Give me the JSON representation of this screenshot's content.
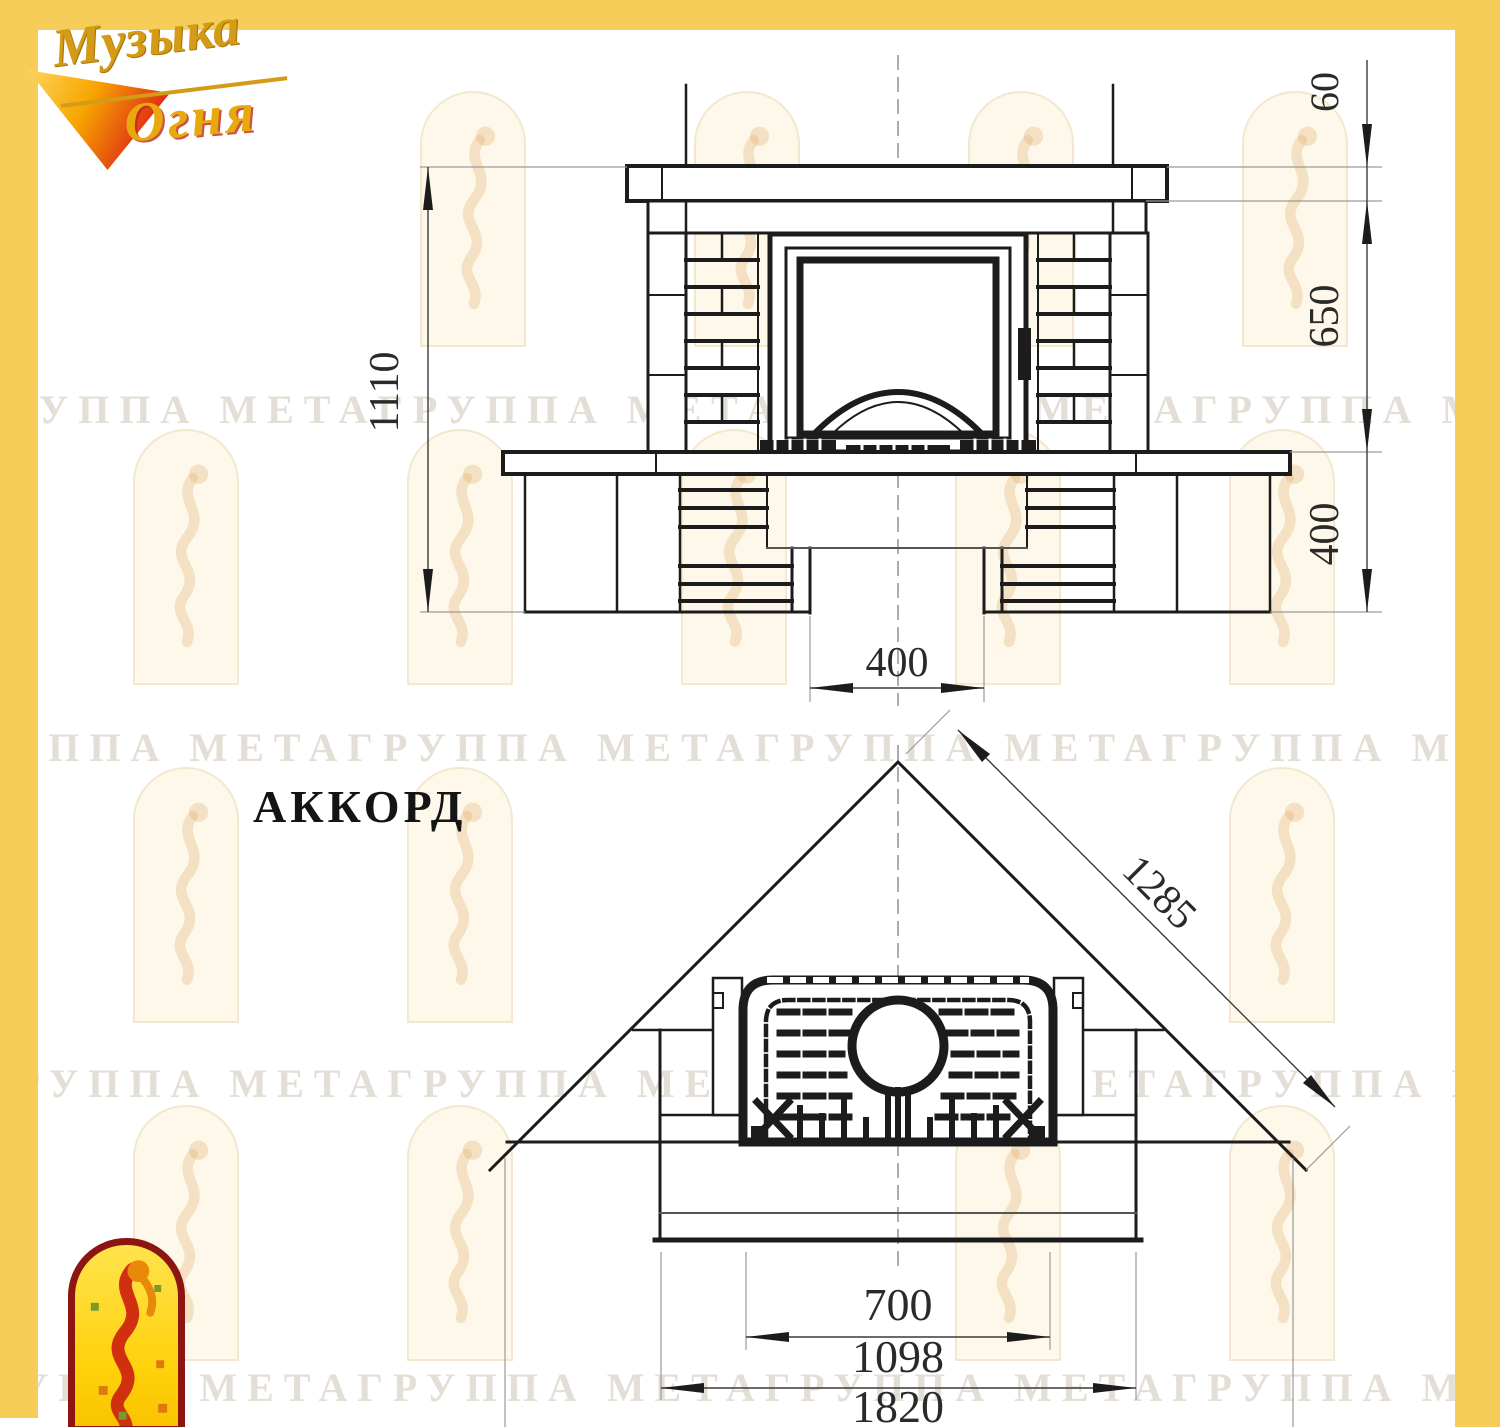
{
  "brand": {
    "name_line1": "Музыка",
    "name_line2": "Огня"
  },
  "model_title": "АККОРД",
  "watermark_text": "ГРУППА МЕТАГРУППА МЕТАГРУППА МЕТАГРУППА МЕТАГРУППА МЕТА",
  "front_view": {
    "dim_total_height": "1110",
    "dim_shelf_offset": "60",
    "dim_firebox_height": "650",
    "dim_plinth_height": "400",
    "dim_recess_width": "400"
  },
  "plan_view": {
    "dim_diagonal_width": "1285",
    "dim_firebox_width": "700",
    "dim_body_width": "1098",
    "dim_overall_width": "1820"
  },
  "colors": {
    "border_yellow": "#f5cd58",
    "line_dark": "#1c1c1c",
    "accent_red": "#c1272d",
    "accent_gold": "#d49b16"
  }
}
